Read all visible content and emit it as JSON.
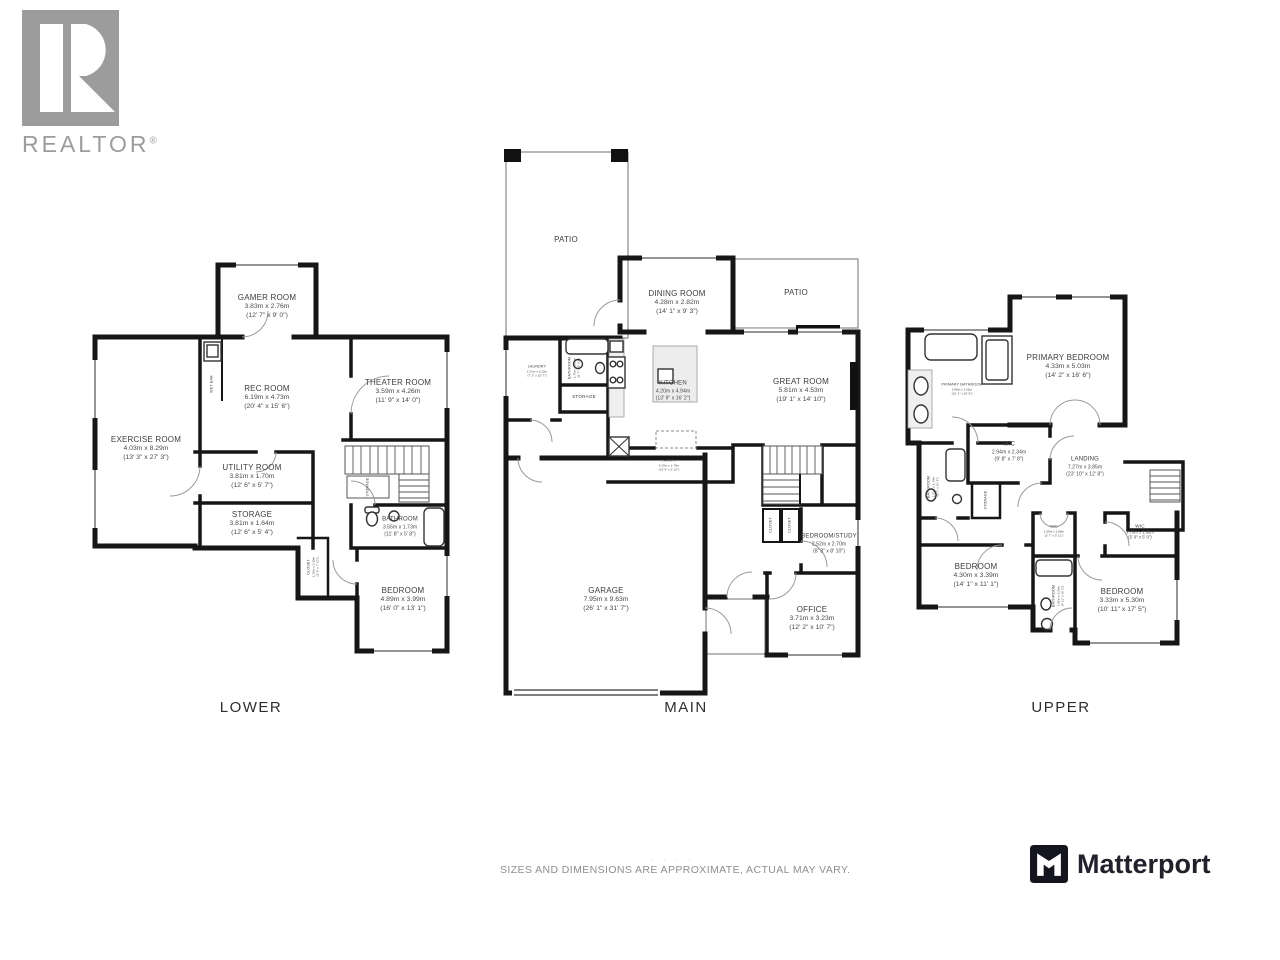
{
  "branding": {
    "realtor_word": "REALTOR",
    "realtor_reg": "®",
    "matterport_word": "Matterport"
  },
  "footer": {
    "disclaimer": "SIZES AND DIMENSIONS ARE APPROXIMATE, ACTUAL MAY VARY.",
    "faint_marks": "· ·   · ·"
  },
  "colors": {
    "wall": "#161616",
    "label_text": "#3c3c3c",
    "logo_gray": "#9c9c9c",
    "matterport_dark": "#21212b"
  },
  "floors": {
    "lower": {
      "label": "LOWER",
      "rooms": {
        "gamer": {
          "name": "GAMER ROOM",
          "metric": "3.83m x 2.76m",
          "imperial": "(12' 7\" x 9' 0\")"
        },
        "rec": {
          "name": "REC ROOM",
          "metric": "6.19m x 4.73m",
          "imperial": "(20' 4\" x 15' 6\")"
        },
        "theater": {
          "name": "THEATER ROOM",
          "metric": "3.59m x 4.26m",
          "imperial": "(11' 9\" x 14' 0\")"
        },
        "exercise": {
          "name": "EXERCISE ROOM",
          "metric": "4.03m x 8.29m",
          "imperial": "(13' 3\" x 27' 3\")"
        },
        "utility": {
          "name": "UTILITY ROOM",
          "metric": "3.81m x 1.70m",
          "imperial": "(12' 6\" x 5' 7\")"
        },
        "storage": {
          "name": "STORAGE",
          "metric": "3.81m x 1.64m",
          "imperial": "(12' 6\" x 5' 4\")"
        },
        "closet": {
          "name": "CLOSET",
          "metric": "1.15m x 2.39m",
          "imperial": "(3' 9\" x 7' 10\")"
        },
        "bathroom": {
          "name": "BATHROOM",
          "metric": "3.55m x 1.73m",
          "imperial": "(11' 8\" x 5' 8\")"
        },
        "bedroom": {
          "name": "BEDROOM",
          "metric": "4.89m x 3.99m",
          "imperial": "(16' 0\" x 13' 1\")"
        },
        "wet_bar": {
          "name": "WET BAR"
        },
        "stair_storage": {
          "name": "STORAGE"
        }
      }
    },
    "main": {
      "label": "MAIN",
      "rooms": {
        "patio_left": {
          "name": "PATIO"
        },
        "dining": {
          "name": "DINING ROOM",
          "metric": "4.28m x 2.82m",
          "imperial": "(14' 1\" x 9' 3\")"
        },
        "patio_right": {
          "name": "PATIO"
        },
        "great": {
          "name": "GREAT ROOM",
          "metric": "5.81m x 4.53m",
          "imperial": "(19' 1\" x 14' 10\")"
        },
        "kitchen": {
          "name": "KITCHEN",
          "metric": "4.20m x 4.94m",
          "imperial": "(13' 9\" x 16' 2\")"
        },
        "laundry": {
          "name": "LAUNDRY",
          "metric": "2.21m x 3.23m",
          "imperial": "(7' 3\" x 10' 7\")"
        },
        "bathroom": {
          "name": "BATHROOM",
          "metric": "1.70m x 3.00m",
          "imperial": "(5' 7\" x 9' 10\")"
        },
        "storage": {
          "name": "STORAGE"
        },
        "pantry": {
          "name": "PANTRY",
          "metric": "4.20m x 1.79m",
          "imperial": "(13' 9\" x 5' 10\")"
        },
        "bedroom_study": {
          "name": "BEDROOM/STUDY",
          "metric": "2.52m x 2.70m",
          "imperial": "(8' 3\" x 8' 10\")"
        },
        "office": {
          "name": "OFFICE",
          "metric": "3.71m x 3.23m",
          "imperial": "(12' 2\" x 10' 7\")"
        },
        "garage": {
          "name": "GARAGE",
          "metric": "7.95m x 9.63m",
          "imperial": "(26' 1\" x 31' 7\")"
        },
        "closet_a": {
          "name": "CLOSET"
        },
        "closet_b": {
          "name": "CLOSET"
        }
      }
    },
    "upper": {
      "label": "UPPER",
      "rooms": {
        "primary_bedroom": {
          "name": "PRIMARY BEDROOM",
          "metric": "4.33m x 5.03m",
          "imperial": "(14' 2\" x 16' 6\")"
        },
        "primary_bathroom": {
          "name": "PRIMARY BATHROOM",
          "metric": "3.08m x 3.20m",
          "imperial": "(10' 1\" x 10' 6\")"
        },
        "wic": {
          "name": "WIC",
          "metric": "2.94m x 2.34m",
          "imperial": "(9' 8\" x 7' 8\")"
        },
        "landing": {
          "name": "LANDING",
          "metric": "7.27m x 3.85m",
          "imperial": "(23' 10\" x 12' 8\")"
        },
        "storage": {
          "name": "STORAGE"
        },
        "bathroom_left": {
          "name": "BATHROOM",
          "metric": "1.52m x 3.14m",
          "imperial": "(5' 0\" x 10' 4\")"
        },
        "wic_small": {
          "name": "WIC",
          "metric": "1.09m x 1.80m",
          "imperial": "(3' 7\" x 5' 11\")"
        },
        "wic_right": {
          "name": "WIC",
          "metric": "1.75m x 1.53m",
          "imperial": "(5' 9\" x 5' 0\")"
        },
        "bedroom_left": {
          "name": "BEDROOM",
          "metric": "4.30m x 3.39m",
          "imperial": "(14' 1\" x 11' 1\")"
        },
        "bedroom_right": {
          "name": "BEDROOM",
          "metric": "3.33m x 5.30m",
          "imperial": "(10' 11\" x 17' 5\")"
        },
        "bathroom_mid": {
          "name": "BATHROOM",
          "metric": "1.50m x 3.05m",
          "imperial": "(4' 11\" x 10' 0\")"
        }
      }
    }
  }
}
